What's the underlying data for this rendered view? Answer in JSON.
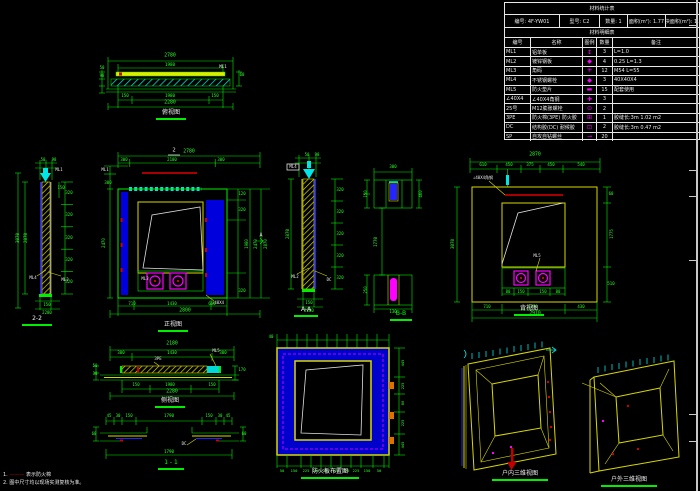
{
  "colors": {
    "green": "#00ef00",
    "cyan": "#00e5e5",
    "yellow": "#d8d800",
    "blue": "#0000dd",
    "magenta": "#ff00ff",
    "red": "#d00000",
    "dark_red": "#a80000",
    "white": "#e8e8e8"
  },
  "table": {
    "title": "材料统计表",
    "info_cells": [
      "编号: 4F-YW01",
      "型号: C2",
      "数量: 1",
      "面积(m²): 1.77",
      "单块面积(m²): 1.21"
    ],
    "subtitle": "材料明细表",
    "headers": [
      "编号",
      "名称",
      "图例",
      "数量",
      "备注"
    ],
    "rows": [
      {
        "code": "ML1",
        "name": "铝单板",
        "sym": "↕",
        "qty": "3",
        "remark": "L=1.0"
      },
      {
        "code": "ML2",
        "name": "镀锌钢板",
        "sym": "◆",
        "qty": "4",
        "remark": "0.25 L=1.3"
      },
      {
        "code": "ML3",
        "name": "角码",
        "sym": "✳",
        "qty": "12",
        "remark": "M54 L=55"
      },
      {
        "code": "ML4",
        "name": "不锈钢螺栓",
        "sym": "◆",
        "qty": "3",
        "remark": "40X40X4"
      },
      {
        "code": "ML5",
        "name": "防火垫片",
        "sym": "▬",
        "qty": "15",
        "remark": "配套使用"
      },
      {
        "code": "∠40X4",
        "name": "∠40X4角钢",
        "sym": "✚",
        "qty": "3",
        "remark": ""
      },
      {
        "code": "25号",
        "name": "M12膨胀螺栓",
        "sym": "⊙",
        "qty": "2",
        "remark": ""
      },
      {
        "code": "3PE",
        "name": "防火棉(3PE) 防火胶",
        "sym": "⊞",
        "qty": "1",
        "remark": "胶缝长:3m  1.02 m2"
      },
      {
        "code": "DC",
        "name": "结构胶(DC) 耐候胶",
        "sym": "⊡",
        "qty": "2",
        "remark": "胶缝长:3m  0.47 m2"
      },
      {
        "code": "SP",
        "name": "自攻自钻螺丝",
        "sym": "→",
        "qty": "20",
        "remark": ""
      }
    ]
  },
  "labels": {
    "plan": "俯视图",
    "left_section": "2-2",
    "front": "正视图",
    "mid_section": "A-A",
    "detail_b": "B-B",
    "rear": "背视图",
    "side": "侧视图",
    "sec11": "1 - 1",
    "panel": "防火板布置图",
    "axon_in": "户内三维视图",
    "axon_out": "户外三维视图"
  },
  "notes": {
    "n1a": "1.",
    "n1b": "———",
    "n1c": "表示防火棉",
    "n2": "2. 图中尺寸均以现场实测复核为准。"
  },
  "views": {
    "plan": {
      "dims": [
        {
          "x": 72,
          "y": 2,
          "t": "2780"
        },
        {
          "x": 72,
          "y": 9.5,
          "t": "1980",
          "s": 4.2
        },
        {
          "x": 125,
          "y": 12,
          "t": "ML1",
          "c": "#e8e8e8",
          "s": 4.2
        },
        {
          "x": 4,
          "y": 13,
          "t": "50",
          "s": 4
        },
        {
          "x": 4,
          "y": 21,
          "t": "98",
          "s": 4
        },
        {
          "x": 144,
          "y": 20,
          "t": "60",
          "s": 4
        },
        {
          "x": 27,
          "y": 41,
          "t": "150",
          "s": 4.2
        },
        {
          "x": 72,
          "y": 41,
          "t": "1980",
          "s": 4.2
        },
        {
          "x": 117,
          "y": 41,
          "t": "150",
          "s": 4.2
        },
        {
          "x": 72,
          "y": 48.5,
          "t": "2280"
        }
      ]
    },
    "left_section": {
      "dims": [
        {
          "x": 28,
          "y": 2,
          "t": "50",
          "s": 4
        },
        {
          "x": 39,
          "y": 2,
          "t": "98",
          "s": 4
        },
        {
          "x": 3,
          "y": 80,
          "t": "3070",
          "r": -90,
          "s": 4.2
        },
        {
          "x": 11,
          "y": 80,
          "t": "2870",
          "r": -90,
          "s": 4.2
        },
        {
          "x": 54,
          "y": 35,
          "t": "320",
          "s": 4
        },
        {
          "x": 54,
          "y": 57,
          "t": "320",
          "s": 4
        },
        {
          "x": 54,
          "y": 80,
          "t": "320",
          "s": 4
        },
        {
          "x": 54,
          "y": 102,
          "t": "320",
          "s": 4
        },
        {
          "x": 54,
          "y": 124,
          "t": "320",
          "s": 4
        },
        {
          "x": 46,
          "y": 30,
          "t": "150",
          "s": 4
        },
        {
          "x": 44,
          "y": 12,
          "t": "ML1",
          "c": "#e8e8e8",
          "s": 4
        },
        {
          "x": 18,
          "y": 120,
          "t": "ML4",
          "c": "#e8e8e8",
          "s": 4
        },
        {
          "x": 50,
          "y": 122,
          "t": "ML2",
          "c": "#e8e8e8",
          "s": 4
        },
        {
          "x": 32,
          "y": 147,
          "t": "150",
          "s": 4
        },
        {
          "x": 32,
          "y": 155,
          "t": "2280",
          "s": 4
        }
      ]
    },
    "center": {
      "dims": [
        {
          "x": 76,
          "y": 3,
          "t": "2",
          "c": "#e8e8e8",
          "s": 5.5
        },
        {
          "x": 91,
          "y": 5,
          "t": "2780"
        },
        {
          "x": 26,
          "y": 12,
          "t": "300",
          "s": 4
        },
        {
          "x": 74,
          "y": 12,
          "t": "2180",
          "s": 4
        },
        {
          "x": 123,
          "y": 12,
          "t": "300",
          "s": 4
        },
        {
          "x": 7,
          "y": 22,
          "t": "ML1",
          "c": "#e8e8e8",
          "s": 4
        },
        {
          "x": 10,
          "y": 35,
          "t": "300",
          "s": 4
        },
        {
          "x": 6,
          "y": 95,
          "t": "2470",
          "r": -90,
          "s": 4
        },
        {
          "x": 144,
          "y": 46,
          "t": "120",
          "s": 4
        },
        {
          "x": 144,
          "y": 62,
          "t": "320",
          "s": 4
        },
        {
          "x": 149,
          "y": 96,
          "t": "1980",
          "r": -90,
          "s": 4
        },
        {
          "x": 144,
          "y": 143,
          "t": "320",
          "s": 4
        },
        {
          "x": 158,
          "y": 96,
          "t": "2470",
          "r": -90,
          "s": 4
        },
        {
          "x": 168,
          "y": 96,
          "t": "2870",
          "r": -90,
          "s": 4
        },
        {
          "x": 163,
          "y": 88,
          "t": "A",
          "c": "#e8e8e8",
          "s": 5
        },
        {
          "x": 47,
          "y": 131,
          "t": "ML3",
          "c": "#e8e8e8",
          "s": 4
        },
        {
          "x": 120,
          "y": 155,
          "t": "∠40X4",
          "c": "#e8e8e8",
          "s": 4
        },
        {
          "x": 34,
          "y": 156,
          "t": "710",
          "s": 4
        },
        {
          "x": 74,
          "y": 156,
          "t": "1430",
          "s": 4
        },
        {
          "x": 114,
          "y": 156,
          "t": "660",
          "s": 4
        },
        {
          "x": 87,
          "y": 164,
          "t": "2800"
        }
      ]
    },
    "mid_section": {
      "dims": [
        {
          "x": 24,
          "y": 2,
          "t": "50",
          "s": 4
        },
        {
          "x": 34,
          "y": 2,
          "t": "98",
          "s": 4
        },
        {
          "x": 10,
          "y": 14,
          "t": "ML4",
          "c": "#e8e8e8",
          "s": 4
        },
        {
          "x": 5,
          "y": 81,
          "t": "2870",
          "r": -90,
          "s": 4.2
        },
        {
          "x": 57,
          "y": 37,
          "t": "320",
          "s": 4
        },
        {
          "x": 57,
          "y": 59,
          "t": "320",
          "s": 4
        },
        {
          "x": 57,
          "y": 81,
          "t": "320",
          "s": 4
        },
        {
          "x": 57,
          "y": 103,
          "t": "320",
          "s": 4
        },
        {
          "x": 57,
          "y": 125,
          "t": "320",
          "s": 4
        },
        {
          "x": 12,
          "y": 124,
          "t": "ML2",
          "c": "#e8e8e8",
          "s": 4
        },
        {
          "x": 46,
          "y": 127,
          "t": "DC",
          "c": "#e8e8e8",
          "s": 4
        },
        {
          "x": 26,
          "y": 150,
          "t": "150",
          "s": 4
        },
        {
          "x": 26,
          "y": 158,
          "t": "2280",
          "s": 4
        }
      ]
    },
    "details": {
      "dims": [
        {
          "x": 31,
          "y": 7,
          "t": "300",
          "s": 4
        },
        {
          "x": 4,
          "y": 34,
          "t": "150",
          "r": -90,
          "s": 4
        },
        {
          "x": 59,
          "y": 34,
          "t": "460",
          "r": -90,
          "s": 4
        },
        {
          "x": 14,
          "y": 82,
          "t": "1770",
          "r": -90,
          "s": 4.2
        },
        {
          "x": 4,
          "y": 130,
          "t": "250",
          "r": -90,
          "s": 4
        },
        {
          "x": 31,
          "y": 152,
          "t": "130",
          "s": 4
        }
      ]
    },
    "rear": {
      "dims": [
        {
          "x": 90,
          "y": 4,
          "t": "2870"
        },
        {
          "x": 38,
          "y": 13,
          "t": "610",
          "s": 4
        },
        {
          "x": 64,
          "y": 13,
          "t": "450",
          "s": 4
        },
        {
          "x": 85,
          "y": 13,
          "t": "375",
          "s": 4
        },
        {
          "x": 106,
          "y": 13,
          "t": "450",
          "s": 4
        },
        {
          "x": 136,
          "y": 13,
          "t": "540",
          "s": 4
        },
        {
          "x": 38,
          "y": 26,
          "t": "∠40X4角钢",
          "c": "#e8e8e8",
          "s": 4
        },
        {
          "x": 8,
          "y": 92,
          "t": "3070",
          "r": -90,
          "s": 4.2
        },
        {
          "x": 166,
          "y": 42,
          "t": "60",
          "s": 4
        },
        {
          "x": 167,
          "y": 82,
          "t": "1775",
          "r": -90,
          "s": 4
        },
        {
          "x": 166,
          "y": 132,
          "t": "510",
          "s": 4
        },
        {
          "x": 92,
          "y": 104,
          "t": "ML5",
          "c": "#e8e8e8",
          "s": 4
        },
        {
          "x": 63,
          "y": 140,
          "t": "80",
          "s": 4
        },
        {
          "x": 76,
          "y": 140,
          "t": "150",
          "s": 4
        },
        {
          "x": 98,
          "y": 140,
          "t": "150",
          "s": 4
        },
        {
          "x": 113,
          "y": 140,
          "t": "80",
          "s": 4
        },
        {
          "x": 42,
          "y": 155,
          "t": "710",
          "s": 4
        },
        {
          "x": 88,
          "y": 155,
          "t": "1770",
          "s": 4
        },
        {
          "x": 136,
          "y": 155,
          "t": "430",
          "s": 4
        },
        {
          "x": 90,
          "y": 163,
          "t": "2910"
        }
      ]
    },
    "side": {
      "dims": [
        {
          "x": 80,
          "y": 3,
          "t": "2180"
        },
        {
          "x": 29,
          "y": 11,
          "t": "300",
          "s": 4
        },
        {
          "x": 80,
          "y": 11,
          "t": "1430",
          "s": 4
        },
        {
          "x": 131,
          "y": 11,
          "t": "300",
          "s": 4
        },
        {
          "x": 66,
          "y": 17,
          "t": "3PE",
          "c": "#e8e8e8",
          "s": 4
        },
        {
          "x": 124,
          "y": 9,
          "t": "ML5",
          "c": "#e8e8e8",
          "s": 4
        },
        {
          "x": 3,
          "y": 24,
          "t": "50",
          "s": 4
        },
        {
          "x": 3,
          "y": 32,
          "t": "30",
          "s": 4
        },
        {
          "x": 150,
          "y": 28,
          "t": "170",
          "s": 4
        },
        {
          "x": 44,
          "y": 43,
          "t": "150",
          "s": 4
        },
        {
          "x": 78,
          "y": 43,
          "t": "1980",
          "s": 4
        },
        {
          "x": 120,
          "y": 43,
          "t": "150",
          "s": 4
        },
        {
          "x": 80,
          "y": 50.5,
          "t": "2280"
        }
      ]
    },
    "sec11": {
      "dims": [
        {
          "x": 17,
          "y": 3,
          "t": "45",
          "s": 4
        },
        {
          "x": 26,
          "y": 3,
          "t": "30",
          "s": 4
        },
        {
          "x": 37,
          "y": 3,
          "t": "150",
          "s": 4
        },
        {
          "x": 77,
          "y": 3,
          "t": "1790",
          "s": 4.2
        },
        {
          "x": 117,
          "y": 3,
          "t": "150",
          "s": 4
        },
        {
          "x": 128,
          "y": 3,
          "t": "30",
          "s": 4
        },
        {
          "x": 136,
          "y": 3,
          "t": "45",
          "s": 4
        },
        {
          "x": 2,
          "y": 21,
          "t": "60",
          "s": 4
        },
        {
          "x": 152,
          "y": 21,
          "t": "60",
          "s": 4
        },
        {
          "x": 92,
          "y": 31,
          "t": "DC",
          "c": "#e8e8e8",
          "s": 4
        },
        {
          "x": 77,
          "y": 39,
          "t": "1790",
          "s": 4.2
        }
      ]
    },
    "panel": {
      "dims": [
        {
          "x": 8,
          "y": 7,
          "t": "40",
          "s": 4
        },
        {
          "x": 19,
          "y": 141,
          "t": "50",
          "s": 3.8
        },
        {
          "x": 31,
          "y": 141,
          "t": "150",
          "s": 3.8
        },
        {
          "x": 43,
          "y": 141,
          "t": "225",
          "s": 3.8
        },
        {
          "x": 53,
          "y": 141,
          "t": "225",
          "s": 3.8
        },
        {
          "x": 63,
          "y": 141,
          "t": "225",
          "s": 3.8
        },
        {
          "x": 73,
          "y": 141,
          "t": "225",
          "s": 3.8
        },
        {
          "x": 83,
          "y": 141,
          "t": "225",
          "s": 3.8
        },
        {
          "x": 93,
          "y": 141,
          "t": "225",
          "s": 3.8
        },
        {
          "x": 104,
          "y": 141,
          "t": "150",
          "s": 3.8
        },
        {
          "x": 116,
          "y": 141,
          "t": "50",
          "s": 3.8
        },
        {
          "x": 140,
          "y": 33,
          "t": "445",
          "r": -90,
          "s": 3.8
        },
        {
          "x": 140,
          "y": 56,
          "t": "225",
          "r": -90,
          "s": 3.8
        },
        {
          "x": 140,
          "y": 73,
          "t": "80",
          "r": -90,
          "s": 3.8
        },
        {
          "x": 140,
          "y": 93,
          "t": "225",
          "r": -90,
          "s": 3.8
        },
        {
          "x": 140,
          "y": 115,
          "t": "445",
          "r": -90,
          "s": 3.8
        }
      ]
    }
  }
}
